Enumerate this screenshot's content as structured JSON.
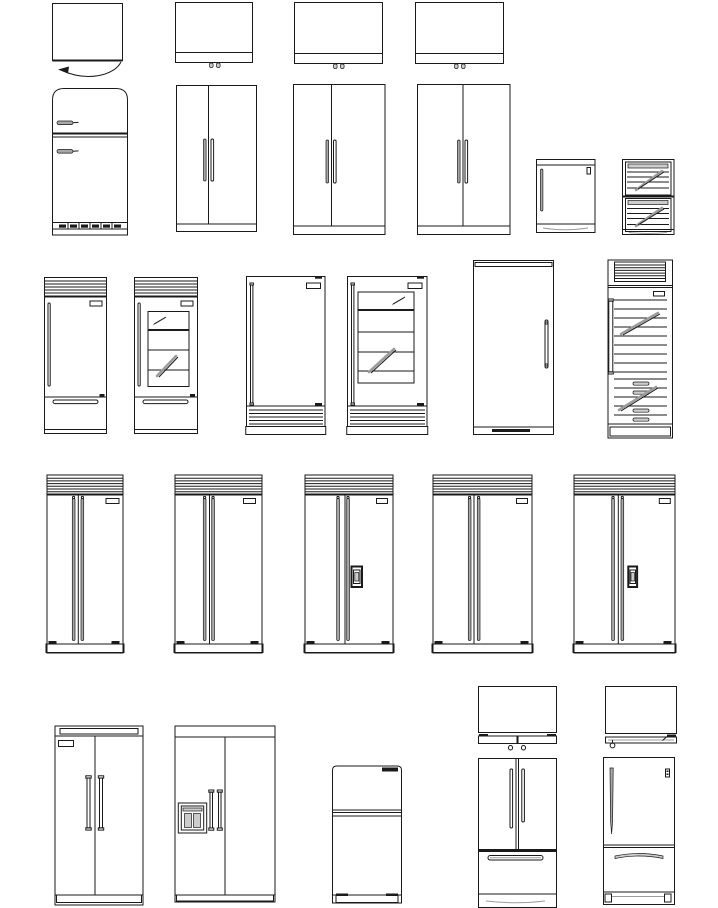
{
  "palette": {
    "background": "#ffffff",
    "line": "#1a1a1a",
    "handle": "#a8a8a8",
    "light": "#cccccc",
    "streak": "#9c9c9c"
  },
  "sheet": {
    "kind": "refrigerator-cad-block-library",
    "text_visible": ""
  },
  "blocks": [
    {
      "id": "plan-compact-door-swing",
      "label": "Compact refrigerator - plan view with door swing arc"
    },
    {
      "id": "plan-fridge-a",
      "label": "Refrigerator - plan view with door and hinges"
    },
    {
      "id": "plan-fridge-b",
      "label": "Refrigerator - plan view with door and hinges"
    },
    {
      "id": "plan-fridge-c",
      "label": "Refrigerator - plan view with door and hinges"
    },
    {
      "id": "retro-top-freezer",
      "label": "Retro top-freezer refrigerator - front elevation"
    },
    {
      "id": "side-by-side-small",
      "label": "Side-by-side refrigerator - front elevation"
    },
    {
      "id": "side-by-side-medium-a",
      "label": "Side-by-side refrigerator - front elevation"
    },
    {
      "id": "side-by-side-medium-b",
      "label": "Side-by-side refrigerator - front elevation"
    },
    {
      "id": "undercounter-fridge",
      "label": "Under-counter refrigerator - front elevation"
    },
    {
      "id": "undercounter-drawer-cooler",
      "label": "Under-counter two-drawer beverage cooler - front elevation"
    },
    {
      "id": "bottom-freezer-grille",
      "label": "Bottom-freezer refrigerator with top grille - front elevation"
    },
    {
      "id": "bottom-freezer-glass-grille",
      "label": "Glass-door bottom-freezer refrigerator with top grille - front elevation"
    },
    {
      "id": "upright-base-grille",
      "label": "Upright refrigerator with base grille - front elevation"
    },
    {
      "id": "upright-glass-base-grille",
      "label": "Glass-door upright refrigerator with base grille - front elevation"
    },
    {
      "id": "column-fridge",
      "label": "Column refrigerator - front elevation"
    },
    {
      "id": "wine-cooler-column",
      "label": "Wine cooler column with racks and drawers - front elevation"
    },
    {
      "id": "sxs-grille-1",
      "label": "Side-by-side refrigerator with top grille - front elevation"
    },
    {
      "id": "sxs-grille-2",
      "label": "Side-by-side refrigerator with top grille - front elevation"
    },
    {
      "id": "sxs-grille-dispenser-1",
      "label": "Side-by-side refrigerator with top grille and dispenser - front elevation"
    },
    {
      "id": "sxs-grille-3",
      "label": "Side-by-side refrigerator with top grille - front elevation"
    },
    {
      "id": "sxs-grille-dispenser-2",
      "label": "Side-by-side refrigerator with top grille and dispenser - front elevation"
    },
    {
      "id": "sxs-capped-handles",
      "label": "Side-by-side refrigerator with capped handles - front elevation"
    },
    {
      "id": "sxs-dispenser-left",
      "label": "Side-by-side refrigerator with ice and water dispenser - front elevation"
    },
    {
      "id": "top-freezer",
      "label": "Top-freezer refrigerator - front elevation"
    },
    {
      "id": "plan-french-door",
      "label": "French-door refrigerator - plan view with hinges"
    },
    {
      "id": "plan-single-door",
      "label": "Single-door refrigerator - plan view with hinge"
    },
    {
      "id": "french-door-bottom-freezer",
      "label": "French-door bottom-freezer refrigerator - front elevation"
    },
    {
      "id": "single-door-bottom-freezer",
      "label": "Single-door bottom-freezer refrigerator - front elevation"
    }
  ]
}
